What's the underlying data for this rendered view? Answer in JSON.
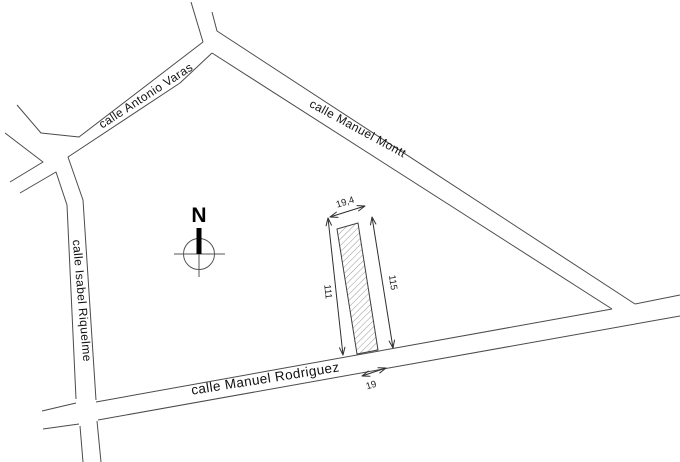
{
  "canvas": {
    "background": "#ffffff"
  },
  "colors": {
    "street_line": "#4b4b4b",
    "dimension_line": "#2e2e2e",
    "hatch": "#7f7f7f",
    "label_text": "#111111",
    "north_bar": "#000000"
  },
  "streets": {
    "antonio_varas": {
      "label": "calle Antonio Varas"
    },
    "manuel_montt": {
      "label": "calle Manuel Montt"
    },
    "isabel_riquelme": {
      "label": "calle Isabel Riquelme"
    },
    "manuel_rodriguez": {
      "label": "calle Manuel Rodriguez"
    }
  },
  "north_indicator": {
    "label": "N"
  },
  "parcel": {
    "dimensions": {
      "top_width": "19,4",
      "left_side": "111",
      "right_side": "115",
      "street_frontage": "19"
    }
  }
}
